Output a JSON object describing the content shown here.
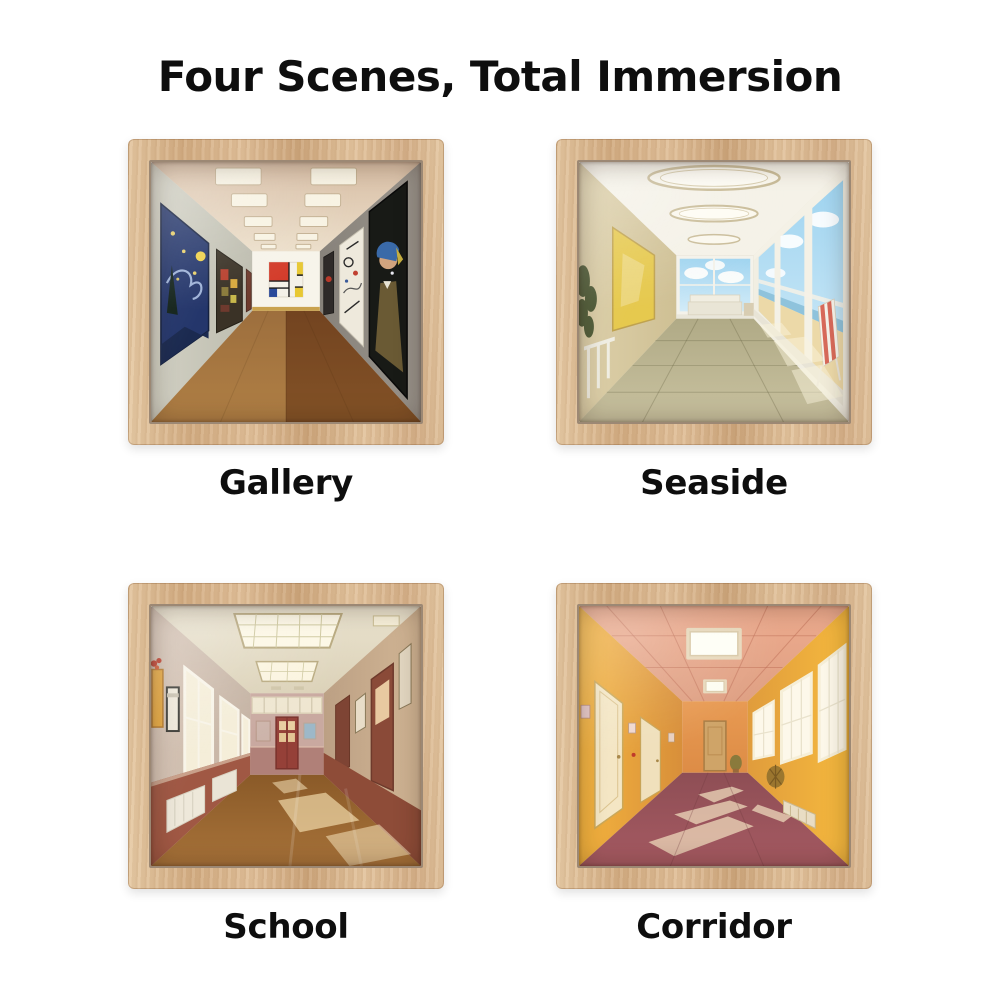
{
  "page": {
    "title": "Four Scenes, Total Immersion",
    "background_color": "#ffffff",
    "text_color": "#0e0e0e"
  },
  "frame": {
    "wood_color": "#dcbb93",
    "bezel_color": "#7a4a2d"
  },
  "scenes": [
    {
      "id": "gallery",
      "label": "Gallery",
      "palette": [
        "#c9c8bb",
        "#938d85",
        "#8a5a2c",
        "#24366b",
        "#d33a28",
        "#e8c832",
        "#f7f4ea"
      ]
    },
    {
      "id": "seaside",
      "label": "Seaside",
      "palette": [
        "#f5f2e8",
        "#d8cba6",
        "#a9d8f0",
        "#ecd9a8",
        "#c0ba96",
        "#d86a5a"
      ]
    },
    {
      "id": "school",
      "label": "School",
      "palette": [
        "#e9e2ce",
        "#d3c1b2",
        "#a05844",
        "#954038",
        "#a06a32",
        "#fdf8e6"
      ]
    },
    {
      "id": "corridor",
      "label": "Corridor",
      "palette": [
        "#eba98c",
        "#f2b23c",
        "#f4e6c4",
        "#a65a62",
        "#fdf8ea",
        "#cfa468"
      ]
    }
  ]
}
